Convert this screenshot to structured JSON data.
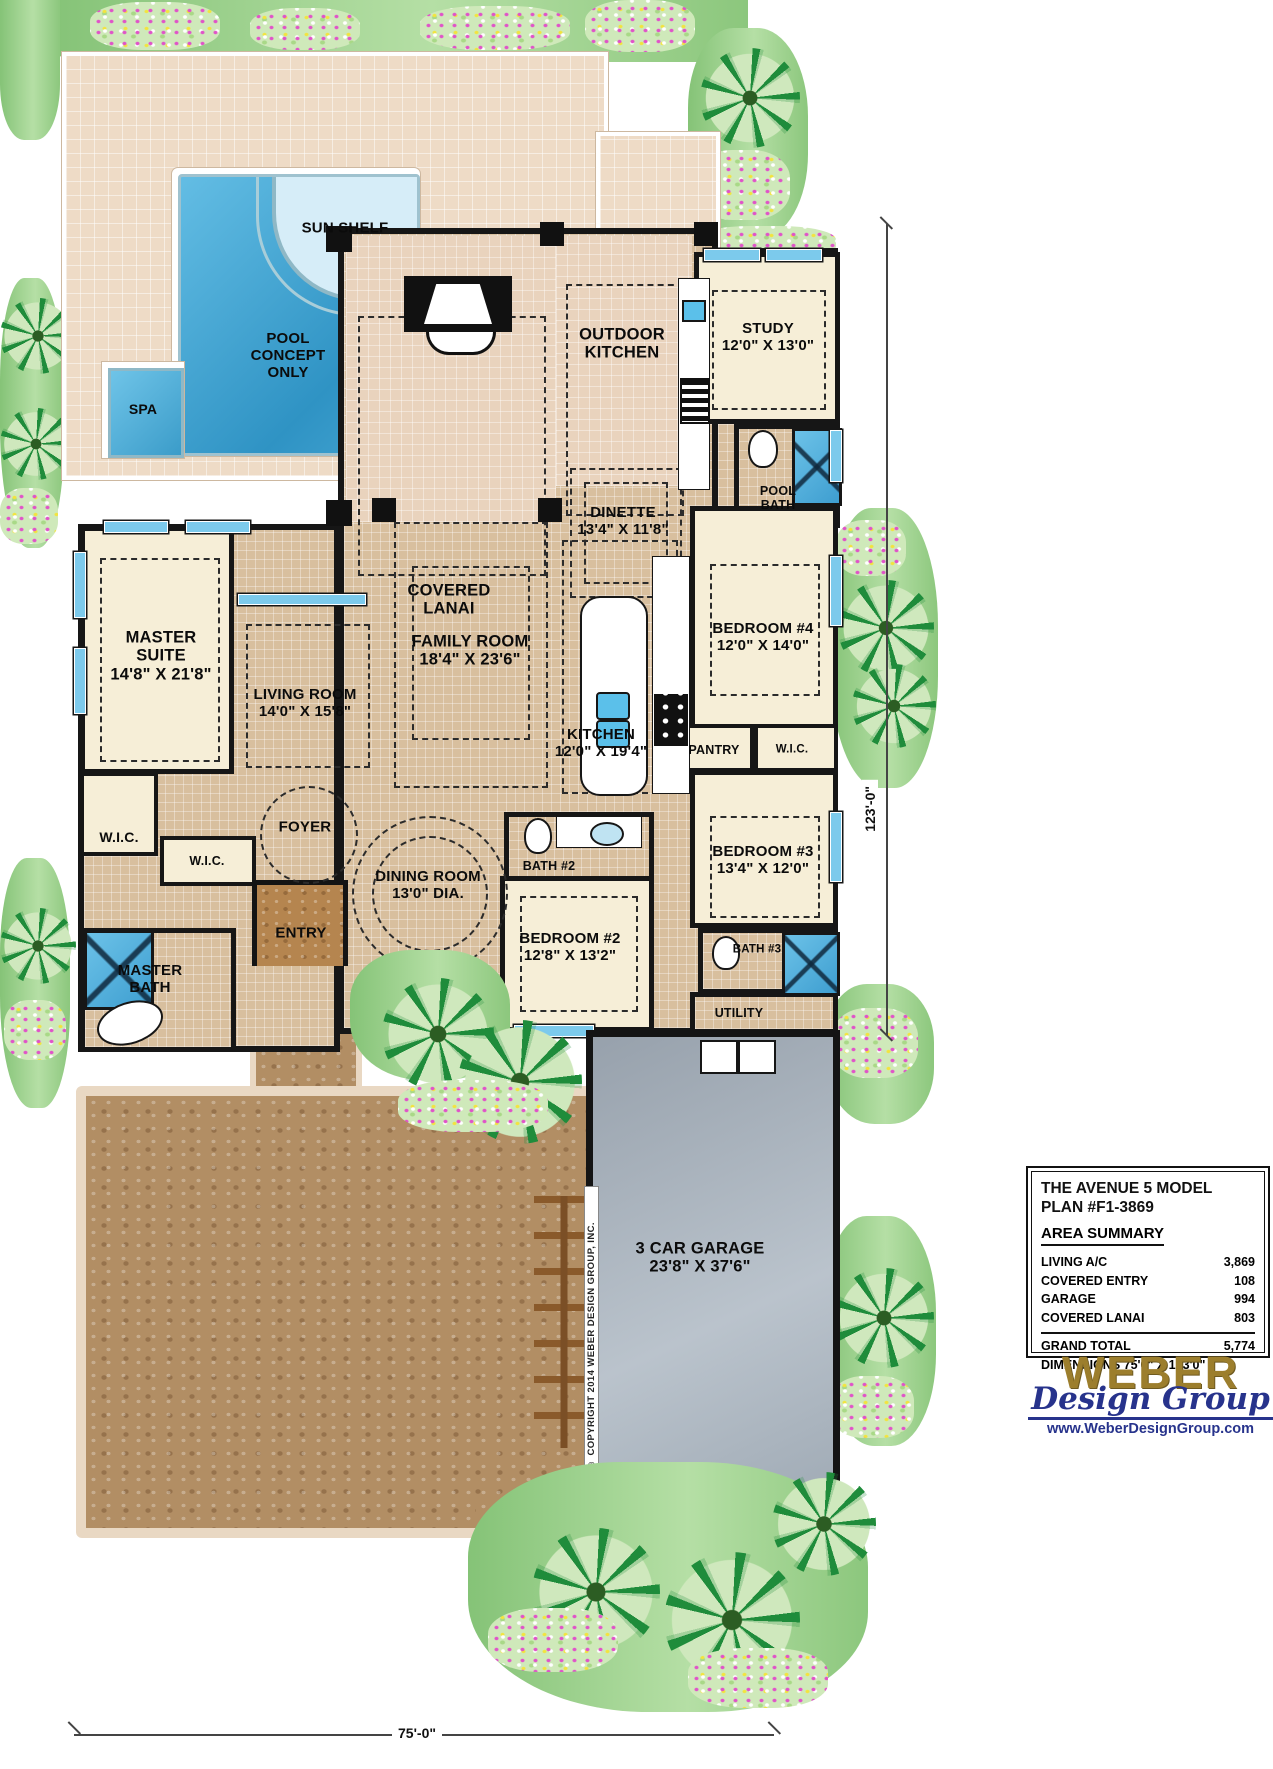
{
  "plan": {
    "title_line1": "THE AVENUE 5 MODEL",
    "title_line2": "PLAN #F1-3869",
    "area_summary_heading": "AREA SUMMARY",
    "areas": [
      {
        "label": "LIVING A/C",
        "value": "3,869"
      },
      {
        "label": "COVERED ENTRY",
        "value": "108"
      },
      {
        "label": "GARAGE",
        "value": "994"
      },
      {
        "label": "COVERED LANAI",
        "value": "803"
      }
    ],
    "grand_total": {
      "label": "GRAND TOTAL",
      "value": "5,774"
    },
    "dimensions_line": "DIMENSIONS 75'0\" X 123'0\""
  },
  "logo": {
    "name": "WEBER",
    "subtitle": "Design Group",
    "url": "www.WeberDesignGroup.com"
  },
  "dimensions": {
    "width_label": "75'-0\"",
    "height_label": "123'-0\""
  },
  "copyright": "© COPYRIGHT 2014 WEBER DESIGN GROUP, INC.",
  "rooms": {
    "sun_shelf": {
      "label": "SUN SHELF"
    },
    "pool": {
      "label": "POOL CONCEPT ONLY"
    },
    "spa": {
      "label": "SPA"
    },
    "covered_lanai": {
      "label": "COVERED LANAI"
    },
    "outdoor_kitchen": {
      "label": "OUTDOOR KITCHEN"
    },
    "study": {
      "label": "STUDY",
      "dims": "12'0\" X 13'0\""
    },
    "pool_bath": {
      "label": "POOL BATH"
    },
    "dinette": {
      "label": "DINETTE",
      "dims": "13'4\" X 11'8\""
    },
    "family_room": {
      "label": "FAMILY ROOM",
      "dims": "18'4\" X 23'6\""
    },
    "master_suite": {
      "label": "MASTER SUITE",
      "dims": "14'8\" X 21'8\""
    },
    "living_room": {
      "label": "LIVING ROOM",
      "dims": "14'0\" X 15'8\""
    },
    "bedroom_4": {
      "label": "BEDROOM #4",
      "dims": "12'0\" X 14'0\""
    },
    "kitchen": {
      "label": "KITCHEN",
      "dims": "12'0\" X 19'4\""
    },
    "pantry": {
      "label": "PANTRY"
    },
    "wic_bedroom4": {
      "label": "W.I.C."
    },
    "bedroom_3": {
      "label": "BEDROOM #3",
      "dims": "13'4\" X 12'0\""
    },
    "wic_master_1": {
      "label": "W.I.C."
    },
    "wic_master_2": {
      "label": "W.I.C."
    },
    "foyer": {
      "label": "FOYER"
    },
    "bath_2": {
      "label": "BATH #2"
    },
    "dining_room": {
      "label": "DINING ROOM",
      "dims": "13'0\" DIA."
    },
    "entry": {
      "label": "ENTRY"
    },
    "master_bath": {
      "label": "MASTER BATH"
    },
    "bedroom_2": {
      "label": "BEDROOM #2",
      "dims": "12'8\" X 13'2\""
    },
    "bath_3": {
      "label": "BATH #3"
    },
    "utility": {
      "label": "UTILITY"
    },
    "garage": {
      "label": "3 CAR GARAGE",
      "dims": "23'8\" X 37'6\""
    }
  },
  "colors": {
    "deck": "#eedbc6",
    "floor_tile": "#d8bf9e",
    "carpet": "#f6eed7",
    "pool_blue": "#3fa9d6",
    "garage_gray": "#a3adb8",
    "driveway_brown": "#b28e64",
    "landscape_green": "#57a84f",
    "logo_gold": "#9c7e2d",
    "logo_blue": "#27338c",
    "wall_black": "#161616"
  }
}
